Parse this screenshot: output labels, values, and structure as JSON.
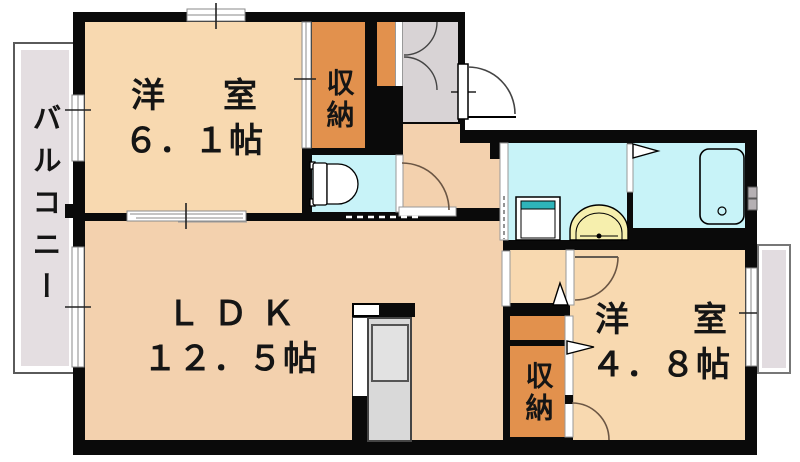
{
  "balcony": {
    "label": "バルコニー"
  },
  "rooms": {
    "western1": {
      "name": "洋　室",
      "size": "６．１帖"
    },
    "ldk": {
      "name": "ＬＤＫ",
      "size": "１２．５帖"
    },
    "western2": {
      "name": "洋　室",
      "size": "４．８帖"
    },
    "storage_top": {
      "label": "収納"
    },
    "storage_bottom": {
      "label": "収納"
    }
  },
  "icons": [
    "toilet-icon",
    "bathtub-icon",
    "washbasin-icon",
    "washing-machine-pan-icon",
    "kitchen-unit-icon",
    "entry-door-arc-icon",
    "room-door-arc-icon",
    "folding-door-triangle-icon",
    "sliding-window-icon"
  ],
  "colors": {
    "wall": "#0a0a0a",
    "western_room": "#f8d9b0",
    "ldk_hall": "#f3d1ae",
    "storage": "#e2914d",
    "water_area": "#c8f3f8",
    "entry_floor": "#d8d3d5",
    "balcony_floor": "#e4dee1",
    "basin_yellow": "#f6efad",
    "washer_teal": "#2fb4ba",
    "kitchen_gray": "#d9d9d9"
  }
}
